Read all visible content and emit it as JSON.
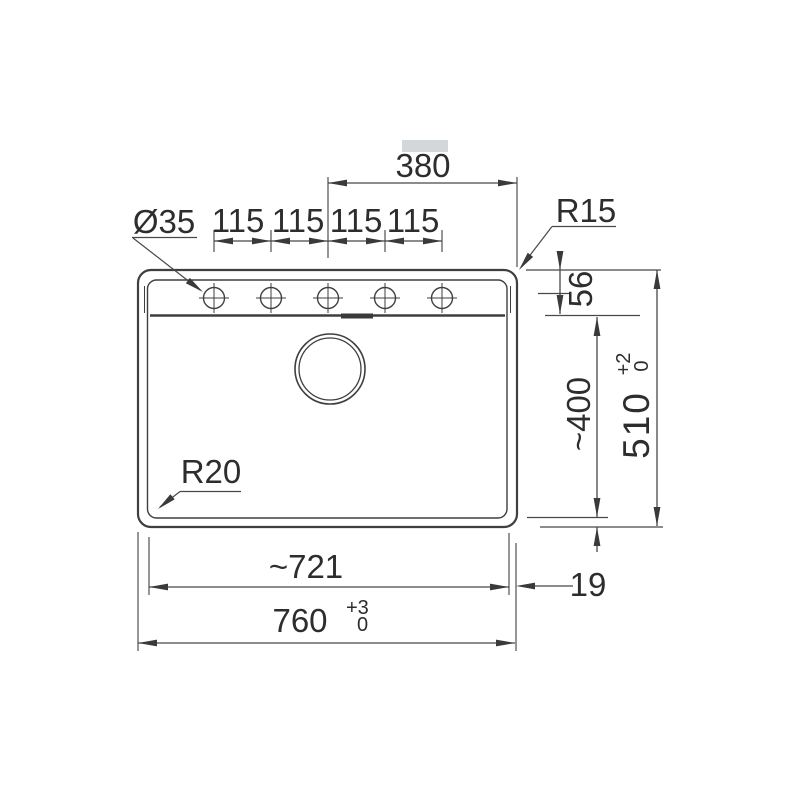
{
  "drawing": {
    "type": "technical-drawing",
    "subject": "kitchen sink top view with installation dimensions",
    "colors": {
      "outline": "#3f3f3f",
      "dimension_line": "#484848",
      "text": "#2d2d2d",
      "background": "#ffffff",
      "artifact": "#cdd0d3"
    },
    "dimensions": {
      "faucet_offset_width": "380",
      "hole_diameter": "Ø35",
      "hole_spacing": [
        "115",
        "115",
        "115",
        "115"
      ],
      "top_corner_radius": "R15",
      "hole_centerline_offset": "56",
      "bowl_depth": "~400",
      "overall_depth": {
        "value": "510",
        "tol_plus": "+2",
        "tol_minus": "0"
      },
      "bowl_width": "~721",
      "rim_width": "19",
      "overall_width": {
        "value": "760",
        "tol_plus": "+3",
        "tol_minus": "0"
      },
      "bowl_corner_radius": "R20"
    }
  }
}
